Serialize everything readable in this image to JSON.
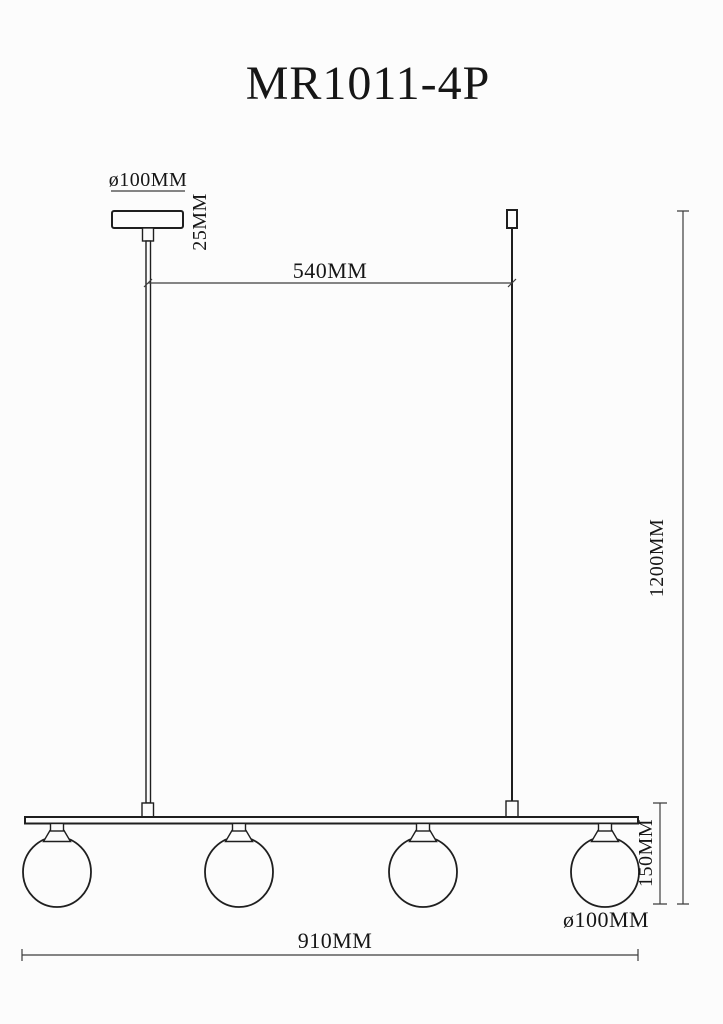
{
  "colors": {
    "outline": "#1f1f1f",
    "dimension": "#3d3d3d",
    "ink": "#161616",
    "background": "#fcfcfc"
  },
  "drawing": {
    "title": "MR1011-4P",
    "labels": {
      "canopy_diameter": "ø100MM",
      "canopy_height": "25MM",
      "suspension_spacing": "540MM",
      "overall_height": "1200MM",
      "shade_height": "150MM",
      "shade_diameter": "ø100MM",
      "fixture_length": "910MM"
    }
  }
}
